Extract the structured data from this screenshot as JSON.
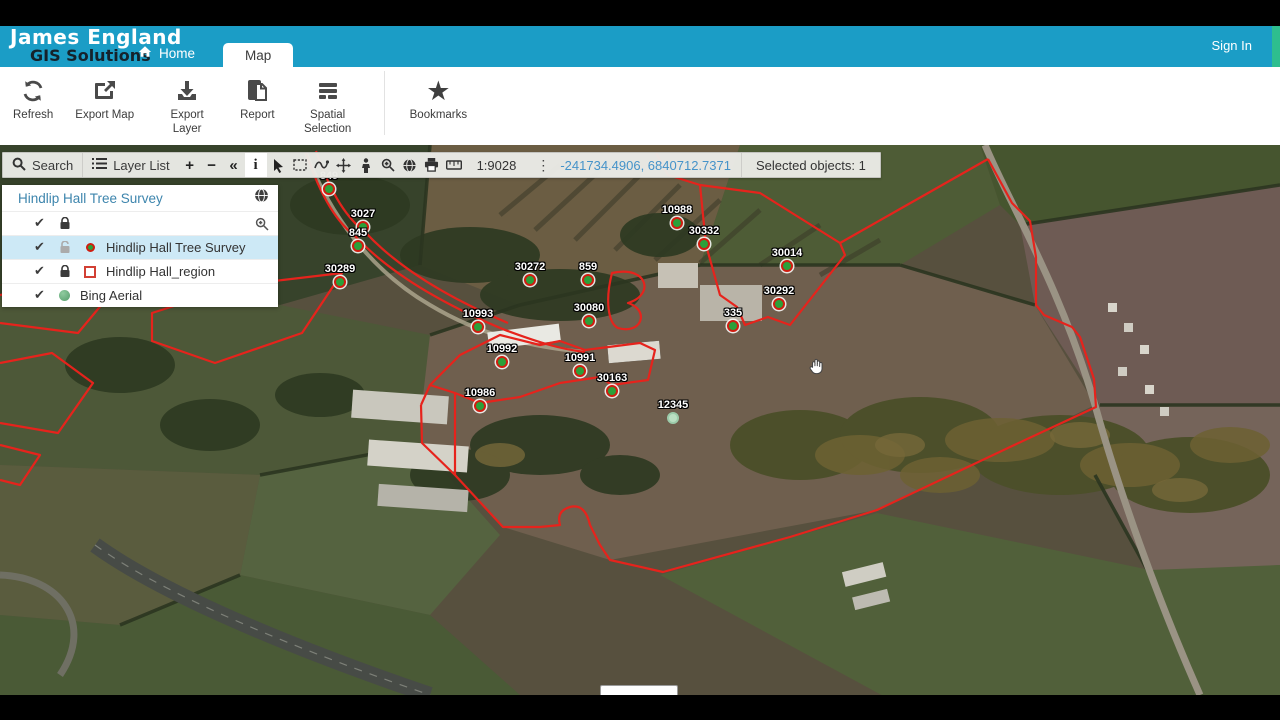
{
  "header": {
    "logo_line1": "James England",
    "logo_line2": "GIS Solutions",
    "home_label": "Home",
    "map_tab_label": "Map",
    "sign_in_label": "Sign In"
  },
  "ribbon": {
    "buttons": [
      {
        "id": "refresh",
        "label": "Refresh"
      },
      {
        "id": "export-map",
        "label": "Export Map"
      },
      {
        "id": "export-layer",
        "label": "Export Layer"
      },
      {
        "id": "report",
        "label": "Report"
      },
      {
        "id": "spatial-selection",
        "label": "Spatial Selection"
      },
      {
        "id": "bookmarks",
        "label": "Bookmarks"
      }
    ]
  },
  "map_toolbar": {
    "search_label": "Search",
    "layer_list_label": "Layer List",
    "zoom_in_glyph": "+",
    "zoom_out_glyph": "−",
    "collapse_glyph": "«",
    "identify_glyph": "i",
    "kebab_glyph": "⋮",
    "scale": "1:9028",
    "coordinates": "-241734.4906, 6840712.7371",
    "selected_objects": "Selected objects: 1",
    "icon_tools": [
      "search-icon",
      "layer-list-icon",
      "zoom-in",
      "zoom-out",
      "collapse",
      "identify",
      "pointer-select-icon",
      "rectangle-select-icon",
      "freehand-draw-icon",
      "pan-icon",
      "street-view-icon",
      "zoom-to-selection-icon",
      "base-map-globe-icon",
      "print-icon",
      "measure-icon"
    ]
  },
  "layer_panel": {
    "title": "Hindlip Hall Tree Survey",
    "rows": [
      {
        "label": "Hindlip Hall Tree Survey",
        "selected": true,
        "lock": "open",
        "swatch": "point"
      },
      {
        "label": "Hindlip Hall_region",
        "selected": false,
        "lock": "closed",
        "swatch": "region"
      },
      {
        "label": "Bing Aerial",
        "selected": false,
        "lock": "none",
        "swatch": "sphere"
      }
    ],
    "check_glyph": "✔"
  },
  "map": {
    "markers": [
      {
        "label": "849",
        "x": 329,
        "y": 44,
        "pale": false
      },
      {
        "label": "3027",
        "x": 363,
        "y": 82,
        "pale": false
      },
      {
        "label": "845",
        "x": 358,
        "y": 101,
        "pale": false
      },
      {
        "label": "30289",
        "x": 340,
        "y": 137,
        "pale": false
      },
      {
        "label": "30272",
        "x": 530,
        "y": 135,
        "pale": false
      },
      {
        "label": "859",
        "x": 588,
        "y": 135,
        "pale": false
      },
      {
        "label": "10988",
        "x": 677,
        "y": 78,
        "pale": false
      },
      {
        "label": "30332",
        "x": 704,
        "y": 99,
        "pale": false
      },
      {
        "label": "30014",
        "x": 787,
        "y": 121,
        "pale": false
      },
      {
        "label": "335",
        "x": 733,
        "y": 181,
        "pale": false
      },
      {
        "label": "30292",
        "x": 779,
        "y": 159,
        "pale": false
      },
      {
        "label": "10993",
        "x": 478,
        "y": 182,
        "pale": false
      },
      {
        "label": "30080",
        "x": 589,
        "y": 176,
        "pale": false
      },
      {
        "label": "10992",
        "x": 502,
        "y": 217,
        "pale": false
      },
      {
        "label": "10991",
        "x": 580,
        "y": 226,
        "pale": false
      },
      {
        "label": "30163",
        "x": 612,
        "y": 246,
        "pale": false
      },
      {
        "label": "10986",
        "x": 480,
        "y": 261,
        "pale": false
      },
      {
        "label": "12345",
        "x": 673,
        "y": 273,
        "pale": true
      }
    ]
  },
  "colors": {
    "header_blue": "#1b9dc6",
    "accent_green": "#2ebe8e",
    "selection_blue": "#cde9f6",
    "boundary_red": "#e6231c",
    "coords_blue": "#4593c9"
  }
}
